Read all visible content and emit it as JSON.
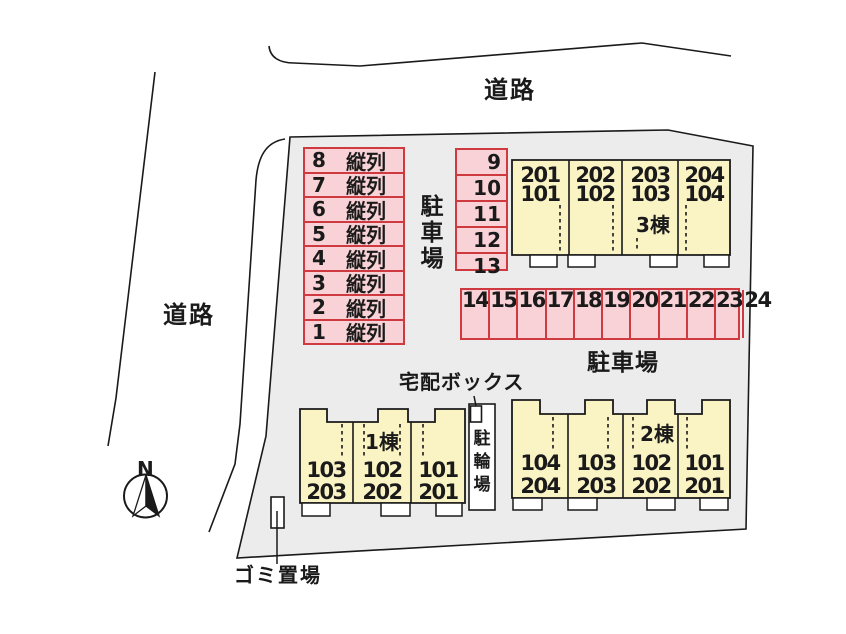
{
  "labels": {
    "road_top": "道路",
    "road_left": "道路",
    "parking_area_left": "駐車場",
    "parking_area_bottom": "駐車場",
    "delivery_box": "宅配ボックス",
    "bicycle_parking": "駐輪場",
    "garbage_area": "ゴミ置場",
    "compass_north": "N"
  },
  "parking": {
    "tandem_column": {
      "spaces": [
        {
          "no": "8",
          "type": "縦列"
        },
        {
          "no": "7",
          "type": "縦列"
        },
        {
          "no": "6",
          "type": "縦列"
        },
        {
          "no": "5",
          "type": "縦列"
        },
        {
          "no": "4",
          "type": "縦列"
        },
        {
          "no": "3",
          "type": "縦列"
        },
        {
          "no": "2",
          "type": "縦列"
        },
        {
          "no": "1",
          "type": "縦列"
        }
      ]
    },
    "middle_column": {
      "spaces": [
        "9",
        "10",
        "11",
        "12",
        "13"
      ]
    },
    "bottom_row": {
      "spaces": [
        "14",
        "15",
        "16",
        "17",
        "18",
        "19",
        "20",
        "21",
        "22",
        "23",
        "24"
      ]
    }
  },
  "buildings": [
    {
      "id": "b3",
      "name": "3棟",
      "units": [
        {
          "upper": "201",
          "lower": "101"
        },
        {
          "upper": "202",
          "lower": "102"
        },
        {
          "upper": "203",
          "lower": "103"
        },
        {
          "upper": "204",
          "lower": "104"
        }
      ]
    },
    {
      "id": "b1",
      "name": "1棟",
      "units": [
        {
          "upper": "103",
          "lower": "203"
        },
        {
          "upper": "102",
          "lower": "202"
        },
        {
          "upper": "101",
          "lower": "201"
        }
      ]
    },
    {
      "id": "b2",
      "name": "2棟",
      "units": [
        {
          "upper": "104",
          "lower": "204"
        },
        {
          "upper": "103",
          "lower": "203"
        },
        {
          "upper": "102",
          "lower": "202"
        },
        {
          "upper": "101",
          "lower": "201"
        }
      ]
    }
  ],
  "colors": {
    "site_fill": "#ececec",
    "parking_fill": "#f8d2d6",
    "parking_border": "#cf3a40",
    "building_fill": "#faf3c4",
    "porch_fill": "#ffffff",
    "outline": "#1a1a1a"
  }
}
